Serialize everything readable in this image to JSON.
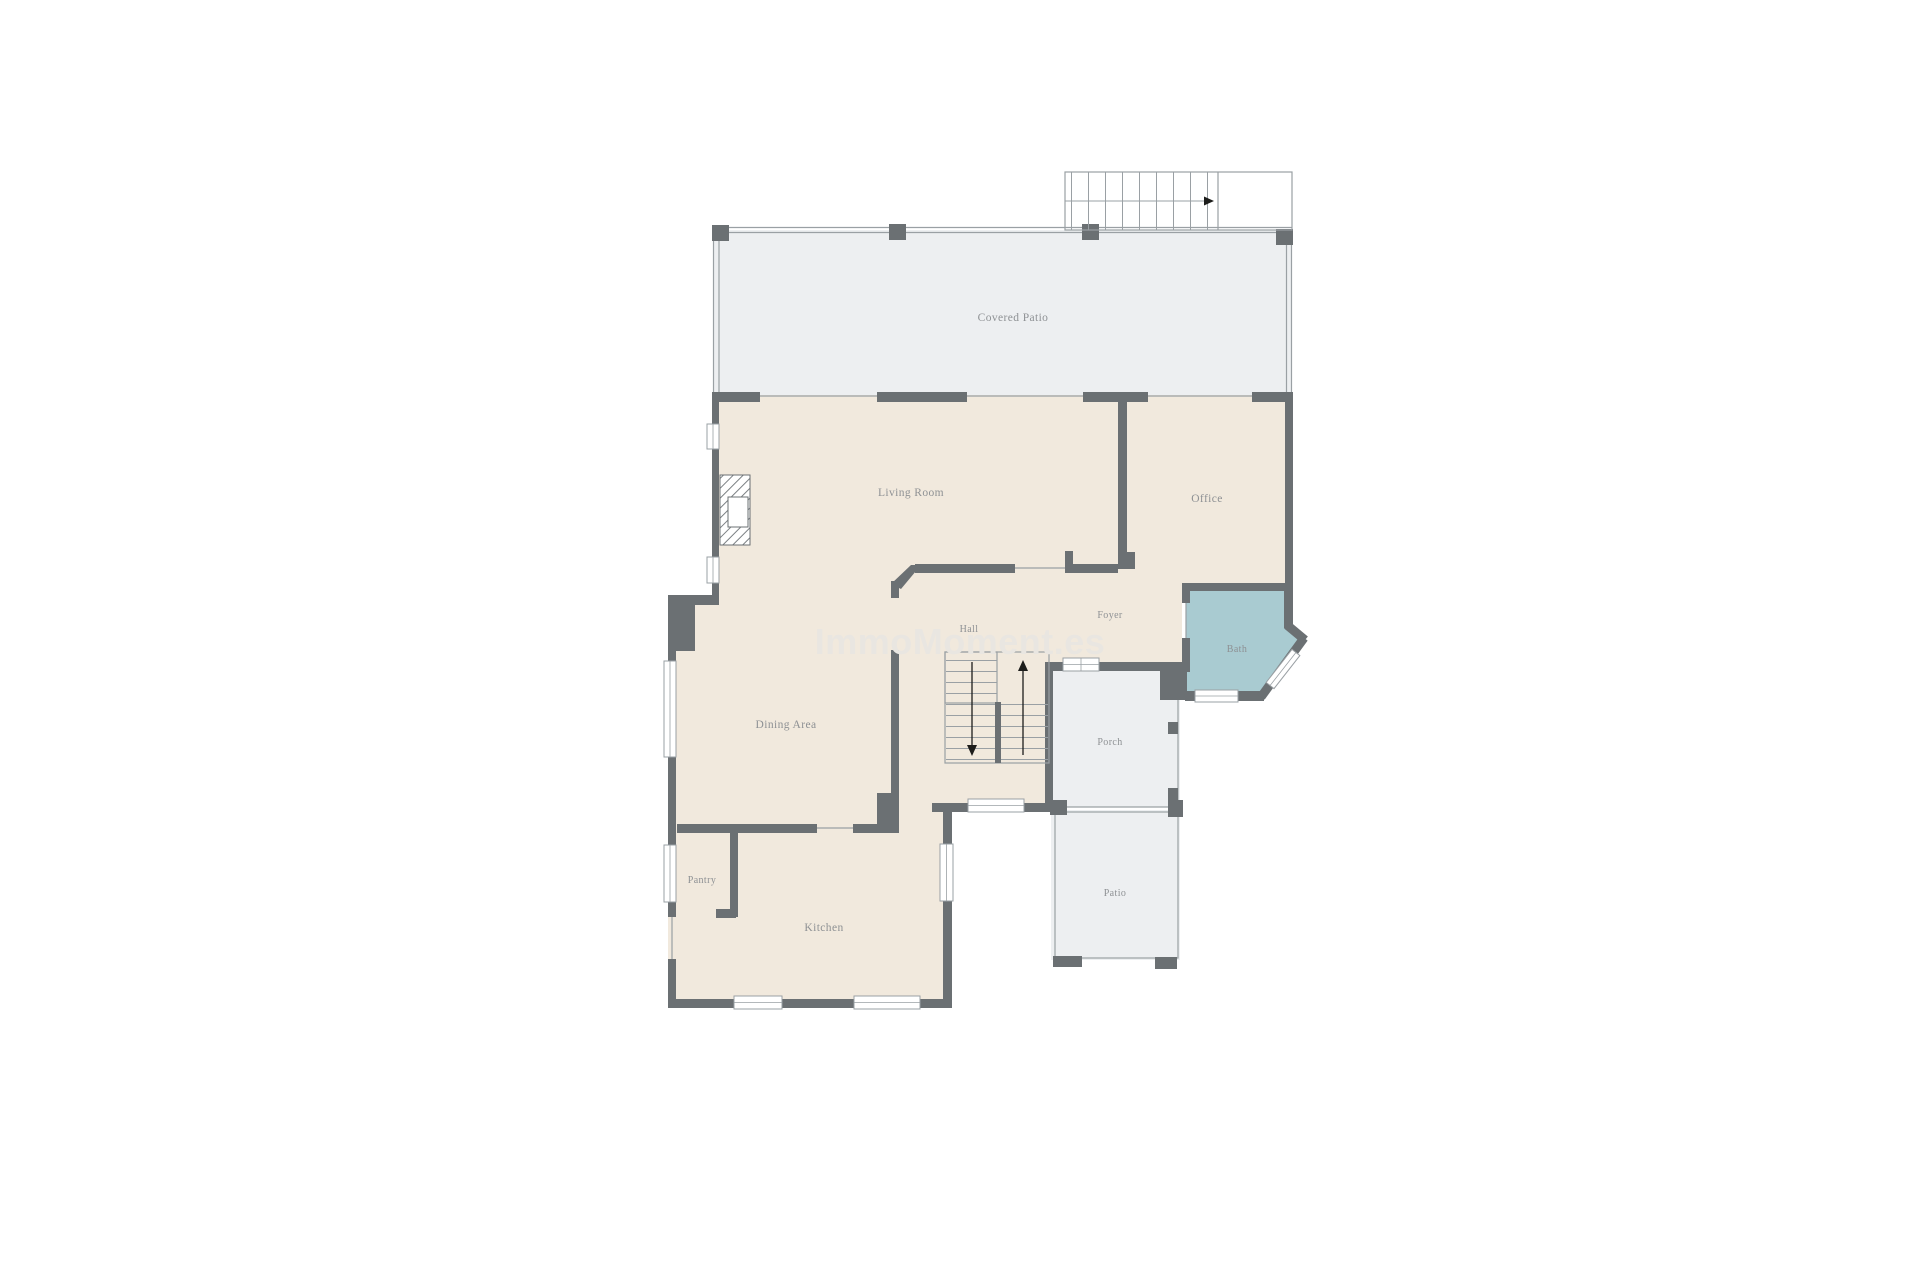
{
  "watermark": {
    "text": "ImmoMoment.es"
  },
  "colors": {
    "wall": "#6b7073",
    "thin": "#9aa0a4",
    "floor": "#f1e9dd",
    "patio": "#edeff1",
    "bath": "#a9cbd1",
    "label": "#8e9194",
    "watermark": "#e9e6e1",
    "arrow": "#1d1d1b"
  },
  "rooms": {
    "covered_patio": {
      "label": "Covered Patio"
    },
    "living_room": {
      "label": "Living Room"
    },
    "office": {
      "label": "Office"
    },
    "hall": {
      "label": "Hall"
    },
    "foyer": {
      "label": "Foyer"
    },
    "bath": {
      "label": "Bath"
    },
    "dining_area": {
      "label": "Dining Area"
    },
    "porch": {
      "label": "Porch"
    },
    "patio": {
      "label": "Patio"
    },
    "pantry": {
      "label": "Pantry"
    },
    "kitchen": {
      "label": "Kitchen"
    }
  }
}
